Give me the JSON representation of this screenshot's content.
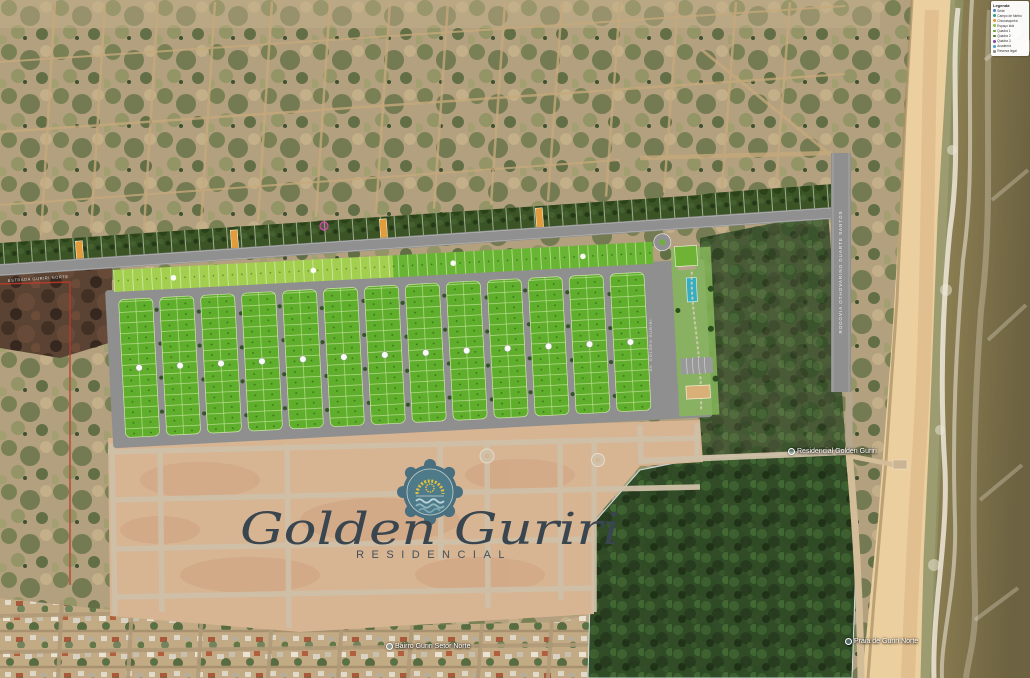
{
  "legend": {
    "title": "Legenda",
    "items": [
      {
        "label": "Sede",
        "color": "#4f86c6"
      },
      {
        "label": "Campo de futebol",
        "color": "#2e9e8f"
      },
      {
        "label": "Churrasqueira",
        "color": "#e09c3b"
      },
      {
        "label": "Espaço kids",
        "color": "#8bc34a"
      },
      {
        "label": "Quadra 1",
        "color": "#61a333"
      },
      {
        "label": "Quadra 2",
        "color": "#3e7d22"
      },
      {
        "label": "Quadra 3",
        "color": "#7d4fa3"
      },
      {
        "label": "Academia",
        "color": "#4aa3c7"
      },
      {
        "label": "Reserva legal",
        "color": "#8a8a8a"
      }
    ]
  },
  "logo": {
    "script": "Golden Guriri",
    "subtitle": "RESIDENCIAL"
  },
  "map_labels": {
    "development_pin": "Residencial Golden Guriri",
    "village_pin": "Bairro Guriri Setor Norte",
    "beach_pin": "Praia de Guriri Norte",
    "coastal_road": "RODOVIA OTHOVARINO DUARTE SANTOS",
    "access_road": "ESTRADA GURIRI NORTE",
    "entrance_road": "AV. GOLDEN GURIRI"
  },
  "colors": {
    "brand_badge": "#4a7080",
    "brand_sun": "#e0c23c",
    "brand_wave": "#8fb6bd",
    "lot_green": "#5fae2c",
    "lot_strip_light": "#a3cf4e",
    "lot_sold_orange": "#e39c3a",
    "reserved_marker_pink": "#d44bb0",
    "reserve_maroon": "#5a4333",
    "road_gray": "#909090",
    "sand": "#d7b492",
    "sea_olive": "#7d7049",
    "forest_green": "#2d4a24"
  }
}
